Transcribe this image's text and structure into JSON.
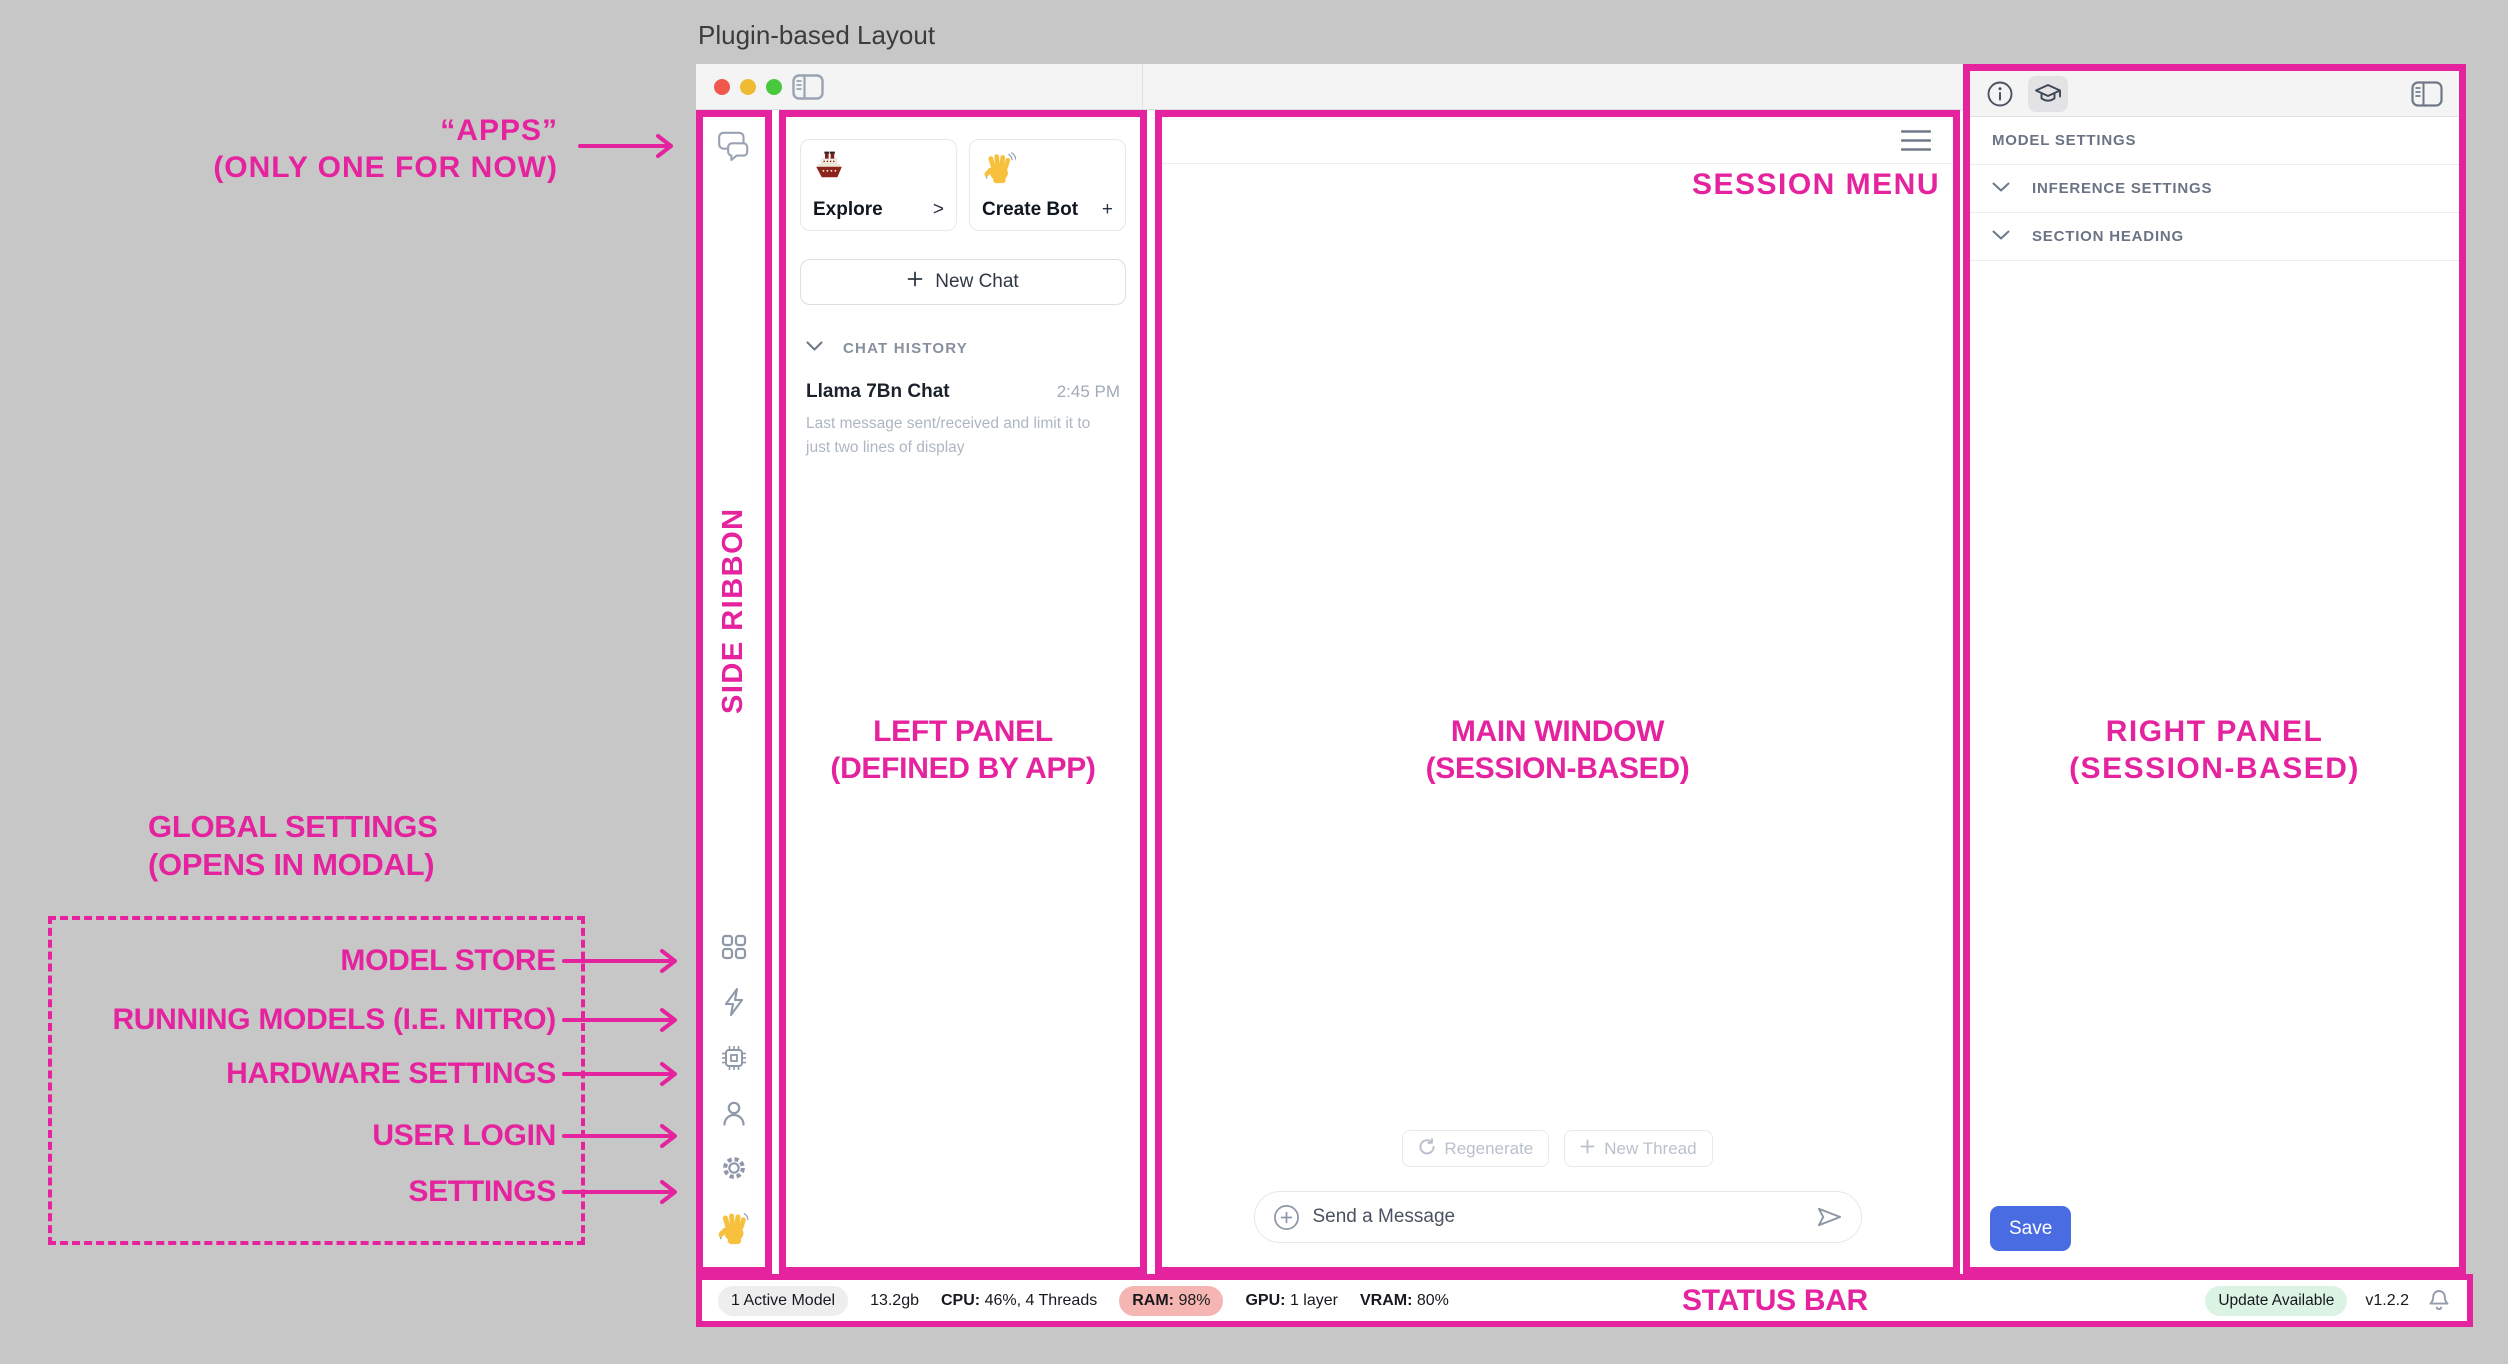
{
  "page_title": "Plugin-based Layout",
  "annotations": {
    "accent_color": "#E5239E",
    "apps_line1": "“APPS”",
    "apps_line2": "(ONLY ONE FOR NOW)",
    "session_menu": "SESSION MENU",
    "side_ribbon": "SIDE RIBBON",
    "left_panel_line1": "LEFT PANEL",
    "left_panel_line2": "(DEFINED BY APP)",
    "main_window_line1": "MAIN WINDOW",
    "main_window_line2": "(SESSION-BASED)",
    "right_panel_line1": "RIGHT PANEL",
    "right_panel_line2": "(SESSION-BASED)",
    "global_line1": "GLOBAL SETTINGS",
    "global_line2": "(OPENS IN MODAL)",
    "ribbon_items": [
      "MODEL STORE",
      "RUNNING MODELS (I.E. NITRO)",
      "HARDWARE SETTINGS",
      "USER LOGIN",
      "SETTINGS"
    ],
    "status_bar": "STATUS BAR"
  },
  "left_panel": {
    "explore_card": {
      "label": "Explore",
      "affordance": ">",
      "icon": "ship-emoji"
    },
    "create_bot_card": {
      "label": "Create Bot",
      "affordance": "+",
      "icon": "wave-emoji"
    },
    "new_chat_label": "New Chat",
    "history_header": "CHAT HISTORY",
    "chat": {
      "title": "Llama 7Bn Chat",
      "time": "2:45 PM",
      "preview": "Last message sent/received and limit it to just two lines of display"
    }
  },
  "main_window": {
    "regenerate_label": "Regenerate",
    "new_thread_label": "New Thread",
    "composer_placeholder": "Send a Message"
  },
  "right_panel": {
    "header": "MODEL SETTINGS",
    "sections": [
      {
        "label": "INFERENCE SETTINGS"
      },
      {
        "label": "SECTION HEADING"
      }
    ],
    "save_label": "Save",
    "save_color": "#4A6CE2"
  },
  "status_bar": {
    "active_model": "1 Active Model",
    "memory": "13.2gb",
    "cpu_label": "CPU:",
    "cpu_value": "46%, 4 Threads",
    "ram_label": "RAM:",
    "ram_value": "98%",
    "gpu_label": "GPU:",
    "gpu_value": "1 layer",
    "vram_label": "VRAM:",
    "vram_value": "80%",
    "update_badge": "Update Available",
    "version": "v1.2.2"
  },
  "icons": {
    "titlebar": [
      "close-traffic-light",
      "minimize-traffic-light",
      "zoom-traffic-light",
      "sidebar-toggle-icon"
    ],
    "side_ribbon": [
      "chat-apps-icon",
      "model-store-grid-icon",
      "running-models-bolt-icon",
      "hardware-chip-icon",
      "user-icon",
      "settings-gear-icon",
      "wave-emoji"
    ],
    "right_panel": [
      "info-icon",
      "assistant-cap-icon",
      "panel-toggle-icon"
    ],
    "main_window": [
      "session-menu-hamburger-icon",
      "regenerate-icon",
      "plus-icon",
      "attach-plus-icon",
      "send-icon"
    ],
    "status_bar": [
      "notification-bell-icon"
    ]
  }
}
